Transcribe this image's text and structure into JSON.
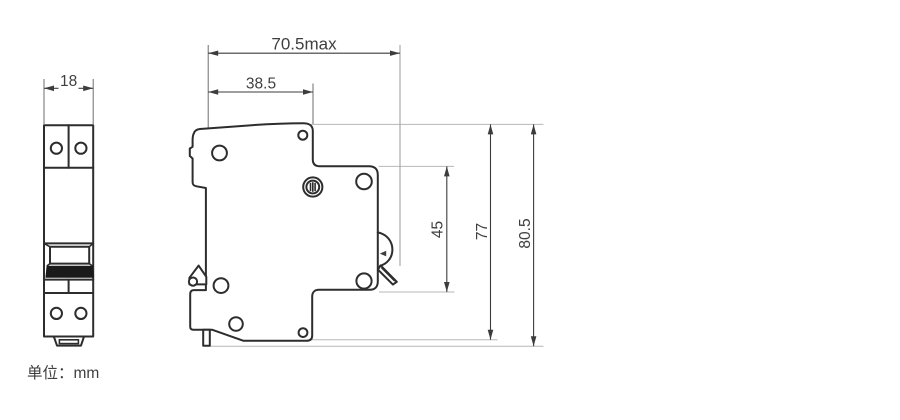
{
  "drawing": {
    "unit_label": "单位：mm",
    "views": {
      "front": {
        "width_mm": "18"
      },
      "side": {
        "max_depth_mm": "70.5max",
        "front_depth_mm": "38.5",
        "recess_height_mm": "45",
        "body_height_mm": "77",
        "overall_height_mm": "80.5"
      }
    },
    "colors": {
      "outline": "#2d2d2d",
      "dimension_text": "#3f3f3f",
      "reference_line": "#b7b7b7",
      "toggle_handle_fill": "#1a1a1a",
      "background": "#ffffff"
    }
  }
}
